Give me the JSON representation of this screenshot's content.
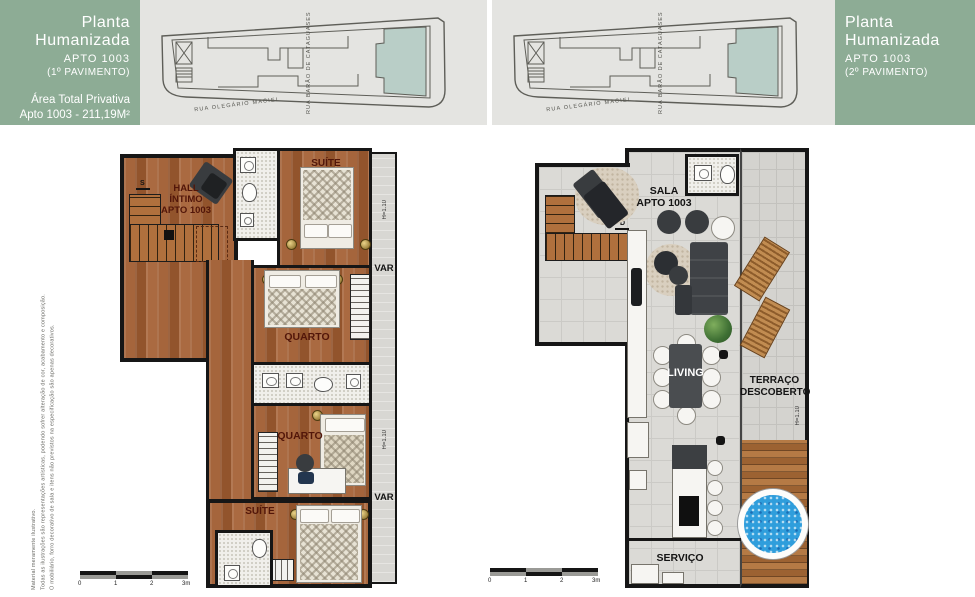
{
  "header_left": {
    "title": "Planta Humanizada",
    "apto": "APTO 1003",
    "floor": "(1º PAVIMENTO)",
    "area_title": "Área Total Privativa",
    "area_value": "Apto 1003 - 211,19M²"
  },
  "header_right": {
    "title": "Planta Humanizada",
    "apto": "APTO 1003",
    "floor": "(2º PAVIMENTO)"
  },
  "maps": {
    "street_bottom": "RUA OLEGÁRIO MACIEL",
    "street_side": "RUA BARÃO DE CATAGUASES"
  },
  "disclaimer": {
    "line1": "Material meramente ilustrativo.",
    "line2": "Todas as ilustrações são representações artísticas, podendo sofrer alteração de cor, acabamento e composição.",
    "line3": "O mobiliário, forro decorativo de sala e itens não previstos na especificação são apenas decorativos."
  },
  "plan1": {
    "hall": "HALL\nÍNTIMO\nAPTO 1003",
    "suite_top": "SUÍTE",
    "quarto_top": "QUARTO",
    "quarto_bottom": "QUARTO",
    "suite_bottom": "SUÍTE",
    "var_top": "VAR",
    "var_bottom": "VAR",
    "h_top": "H=1.10",
    "h_bottom": "H=1.10",
    "stairs_dir": "S"
  },
  "plan2": {
    "sala": "SALA\nAPTO 1003",
    "living": "LIVING",
    "terraco": "TERRAÇO\nDESCOBERTO",
    "servico": "SERVIÇO",
    "h_label": "H=1.10",
    "stairs_dir": "D"
  },
  "scalebar": {
    "labels": [
      "0",
      "1",
      "2",
      "3m"
    ]
  },
  "colors": {
    "header_green": "#8dac95",
    "panel_gray": "#e4e4e1",
    "map_highlight": "#b9cec7",
    "wall": "#161616",
    "wood": "#9d5c33",
    "pool_blue": "#2f9edc"
  }
}
